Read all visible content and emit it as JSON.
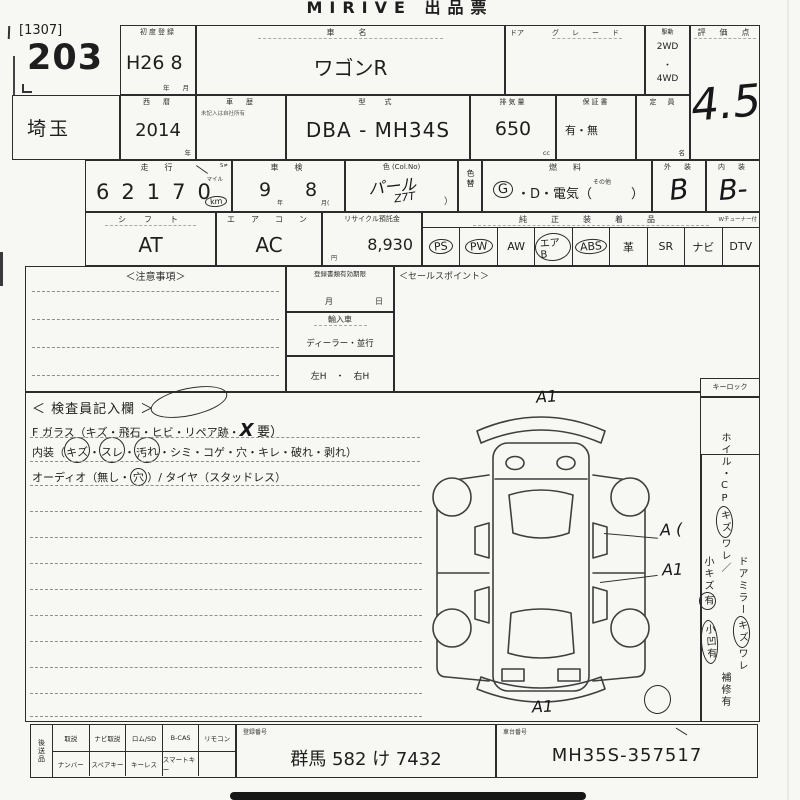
{
  "title": "MIRIVE 出品票",
  "lot": {
    "prefix": "[1307]",
    "number": "203"
  },
  "row1": {
    "first_reg_label": "初度登録",
    "first_reg_value": "H26 8",
    "first_reg_year_unit": "年",
    "first_reg_month_unit": "月",
    "car_name_label": "車　名",
    "car_name_value": "ワゴンR",
    "door_label": "ドア",
    "grade_label": "グ　レ　ー　ド",
    "drive_label": "駆動",
    "drive_2wd": "2WD",
    "drive_dot": "・",
    "drive_4wd": "4WD",
    "score_label": "評　価　点",
    "score_value": "4.5"
  },
  "row2": {
    "prefecture": "埼玉",
    "year_label": "西　暦",
    "year_value": "2014",
    "year_unit": "年",
    "history_label": "車　歴",
    "history_note": "未記入は自社所有",
    "model_label": "型　式",
    "model_value": "DBA - MH34S",
    "displacement_label": "排気量",
    "displacement_value": "650",
    "displacement_unit": "cc",
    "warranty_label": "保証書",
    "warranty_value": "有・無",
    "capacity_label": "定　員",
    "capacity_unit": "名"
  },
  "row3": {
    "mileage_label": "走　行",
    "mileage_value": "62170",
    "mileage_note": "S≠",
    "mile_unit": "マイル",
    "km_unit": "km",
    "inspection_label": "車　検",
    "inspection_year": "9",
    "inspection_year_unit": "年",
    "inspection_month": "8",
    "inspection_month_unit": "月(",
    "color_label": "色 (Col.No)",
    "color_value": "パール",
    "color_code": "Z7T",
    "color_paren": "）",
    "fuel_label": "燃　料",
    "fuel_gas": "G",
    "fuel_options": "・D・電気（",
    "fuel_other": "その他",
    "fuel_close": "）",
    "color_change_label": "色替",
    "exterior_label": "外　装",
    "exterior_value": "B",
    "interior_label": "内　装",
    "interior_value": "B-"
  },
  "row4": {
    "shift_label": "シ　フ　ト",
    "shift_value": "AT",
    "aircon_label": "エ　ア　コ　ン",
    "aircon_value": "AC",
    "recycle_label": "リサイクル預託金",
    "recycle_value": "8,930",
    "recycle_unit": "円",
    "equipment_label": "純　正　装　着　品",
    "equipment_note": "Wチューナー付",
    "equipment": [
      {
        "label": "PS",
        "circled": true
      },
      {
        "label": "PW",
        "circled": true
      },
      {
        "label": "AW",
        "circled": false
      },
      {
        "label": "エアB",
        "circled": true
      },
      {
        "label": "ABS",
        "circled": true
      },
      {
        "label": "革",
        "circled": false
      },
      {
        "label": "SR",
        "circled": false
      },
      {
        "label": "ナビ",
        "circled": false
      },
      {
        "label": "DTV",
        "circled": false
      }
    ]
  },
  "notices": {
    "caution_label": "＜注意事項＞",
    "docs_label": "登録書類有効期限",
    "docs_month": "月",
    "docs_day": "日",
    "import_label": "輸入車",
    "dealer_label": "ディーラー・並行",
    "steering_label": "左H　・　右H",
    "sales_label": "＜セールスポイント＞",
    "keylock_label": "キーロック"
  },
  "inspector": {
    "title": "＜ 検査員記入欄 ＞",
    "glass_pre": "F ガラス（キズ・飛石・ヒビ・リペア跡・",
    "glass_mark": "X",
    "glass_post": "要）",
    "interior_pre": "内装（",
    "interior_c1": "キズ",
    "dot1": "・",
    "interior_c2": "スレ",
    "dot2": "・",
    "interior_c3": "汚れ",
    "interior_post": "・シミ・コゲ・穴・キレ・破れ・剥れ）",
    "audio_pre": "オーディオ（無し・",
    "audio_circled": "穴",
    "audio_post": "）/ タイヤ（スタッドレス）"
  },
  "diagram_marks": {
    "top": "A1",
    "right1": "A (",
    "right2": "A1",
    "bottom": "A1"
  },
  "sidebar": {
    "wheel_label": "ホイル・CP",
    "wheel_c1": "キズ",
    "wheel_rest": "ワレ／",
    "small_scratch_pre": "小キズ",
    "small_scratch_c": "有",
    "mirror_label": "ドアミラー",
    "mirror_c1": "キズ",
    "mirror_rest": "ワレ",
    "dent_c": "小凹有",
    "repair": "補修有"
  },
  "bottom": {
    "later_items_label": "後送品",
    "row1": [
      "取説",
      "ナビ取説",
      "ロム/SD",
      "B-CAS",
      "リモコン"
    ],
    "row2": [
      "ナンバー",
      "スペアキー",
      "キーレス",
      "スマートキー",
      ""
    ],
    "reg_label": "登録番号",
    "reg_value": "群馬 582 け 7432",
    "vin_label": "車台番号",
    "vin_value": "MH35S-357517"
  }
}
